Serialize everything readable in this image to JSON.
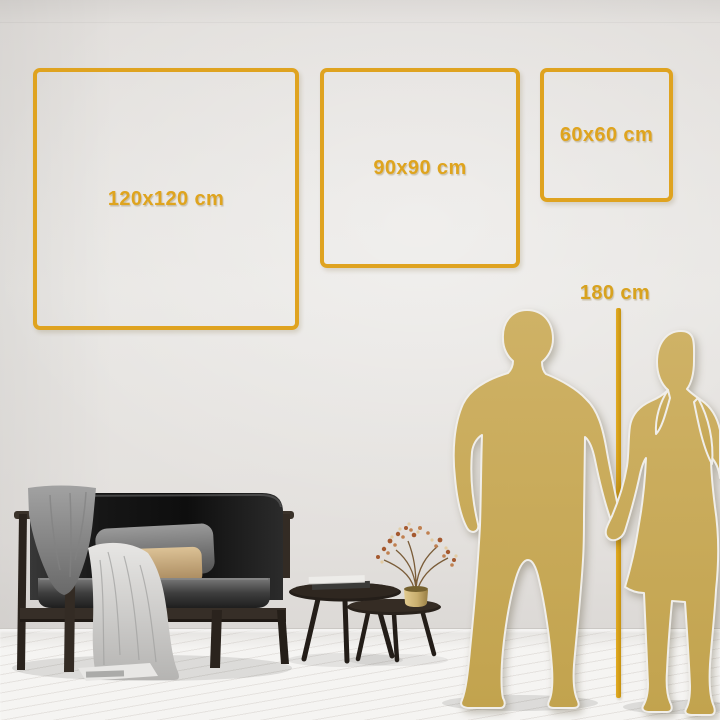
{
  "size_guide": {
    "squares": [
      {
        "id": "120",
        "label": "120x120 cm"
      },
      {
        "id": "90",
        "label": "90x90 cm"
      },
      {
        "id": "60",
        "label": "60x60 cm"
      }
    ],
    "height_marker": {
      "label": "180 cm"
    }
  },
  "colors": {
    "accent_gold": "#DFA41E",
    "silhouette_gold": "#C8AB59",
    "wall": "#E6E4E1",
    "floor": "#F3F2F0",
    "sofa_black": "#141414",
    "pillow_tan": "#C9A87B"
  },
  "scene": {
    "objects": [
      "dark-velvet-sofa",
      "gray-blanket",
      "white-throw-blanket",
      "gray-pillow",
      "tan-pillow",
      "nesting-coffee-tables",
      "stacked-books",
      "gold-vase-with-dried-branch",
      "couple-silhouette",
      "height-measuring-line",
      "white-wood-floor"
    ]
  }
}
